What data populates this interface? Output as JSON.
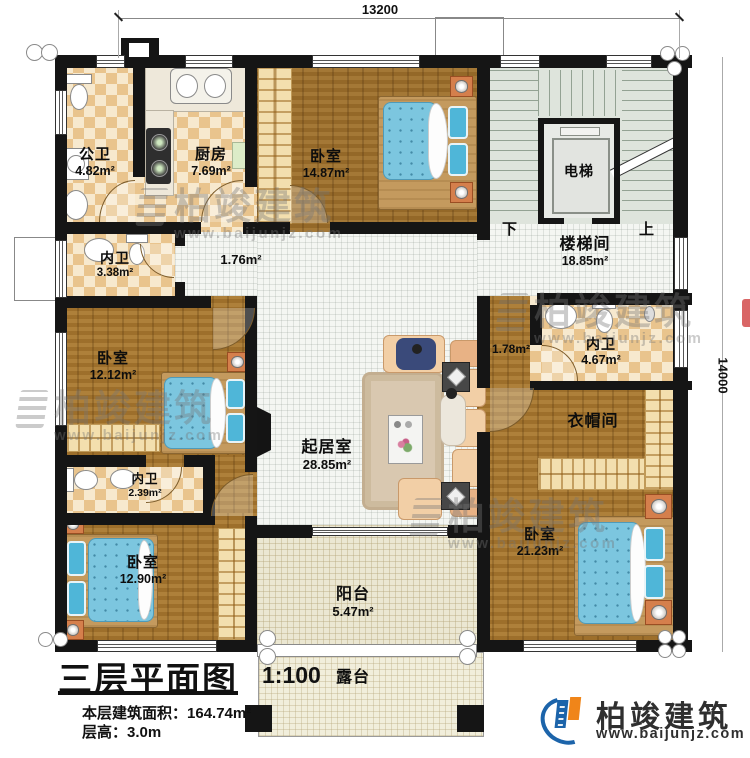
{
  "dimensions": {
    "width_top": "13200",
    "height_right": "14000"
  },
  "title_block": {
    "title": "三层平面图",
    "scale": "1:100",
    "area_label": "本层建筑面积：",
    "area_value": "164.74m²",
    "height_label": "层高：",
    "height_value": "3.0m"
  },
  "brand": {
    "name": "柏竣建筑",
    "url": "www.baijunjz.com"
  },
  "watermark": {
    "name": "柏竣建筑",
    "url": "www.baijunjz.com"
  },
  "stairs": {
    "down_label": "下",
    "up_label": "上"
  },
  "rooms": {
    "public_bath": {
      "name": "公卫",
      "area": "4.82m²"
    },
    "kitchen": {
      "name": "厨房",
      "area": "7.69m²"
    },
    "bedroom_north": {
      "name": "卧室",
      "area": "14.87m²"
    },
    "stairwell": {
      "name": "楼梯间",
      "area": "18.85m²"
    },
    "elevator": {
      "name": "电梯"
    },
    "inner_bath_north": {
      "name": "内卫",
      "area": "3.38m²"
    },
    "hallway": {
      "area": "1.76m²"
    },
    "bedroom_west": {
      "name": "卧室",
      "area": "12.12m²"
    },
    "living": {
      "name": "起居室",
      "area": "28.85m²"
    },
    "suite_hall": {
      "area": "1.78m²"
    },
    "inner_bath_east": {
      "name": "内卫",
      "area": "4.67m²"
    },
    "cloakroom": {
      "name": "衣帽间"
    },
    "inner_bath_southwest": {
      "name": "内卫",
      "area": "2.39m²"
    },
    "bedroom_southwest": {
      "name": "卧室",
      "area": "12.90m²"
    },
    "bedroom_southeast": {
      "name": "卧室",
      "area": "21.23m²"
    },
    "balcony": {
      "name": "阳台",
      "area": "5.47m²"
    },
    "terrace": {
      "name": "露台"
    }
  },
  "colors": {
    "wall": "#151515",
    "wood": "#a5762f",
    "mattress": "#7cc6df",
    "logo_blue": "#1c64aa",
    "logo_orange": "#f08519"
  }
}
